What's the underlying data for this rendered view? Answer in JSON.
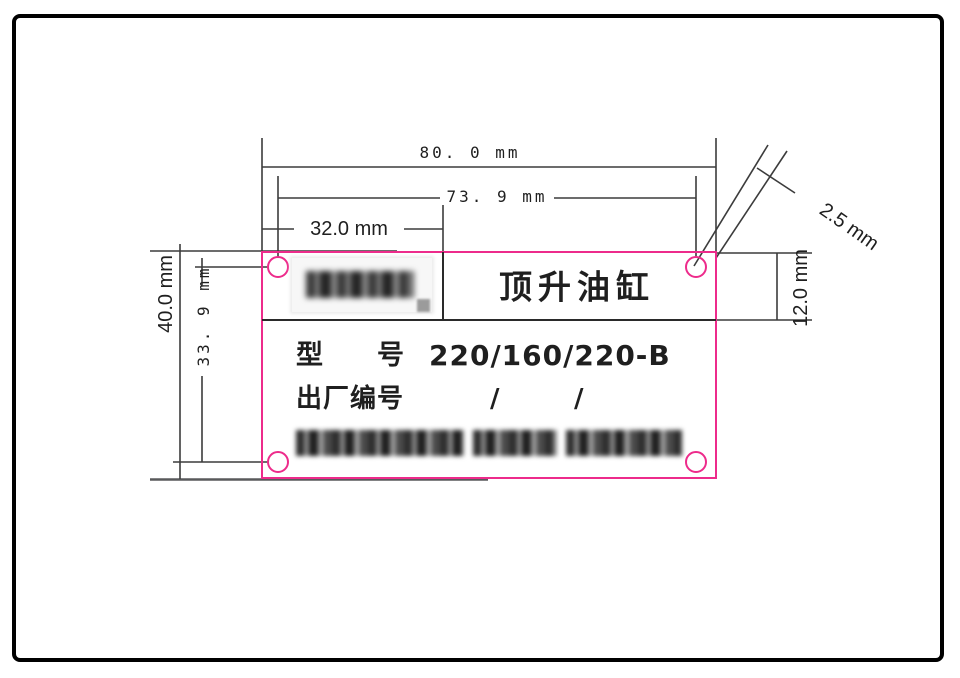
{
  "drawing": {
    "dimensions": {
      "total_width": "80. 0 mm",
      "hole_span_width": "73. 9 mm",
      "left_cell_width": "32.0 mm",
      "total_height": "40.0 mm",
      "hole_span_height": "33. 9 mm",
      "title_row_height": "12.0 mm",
      "hole_diameter": "2.5 mm"
    },
    "plate": {
      "title": "顶升油缸",
      "model_label_first": "型",
      "model_label_second": "号",
      "model_value": "220/160/220-B",
      "serial_label": "出厂编号",
      "serial_slash_1": "/",
      "serial_slash_2": "/"
    },
    "colors": {
      "cut_line": "#ed2b8b",
      "draw_line": "#3c3c3c",
      "text": "#1f1f1f"
    }
  }
}
